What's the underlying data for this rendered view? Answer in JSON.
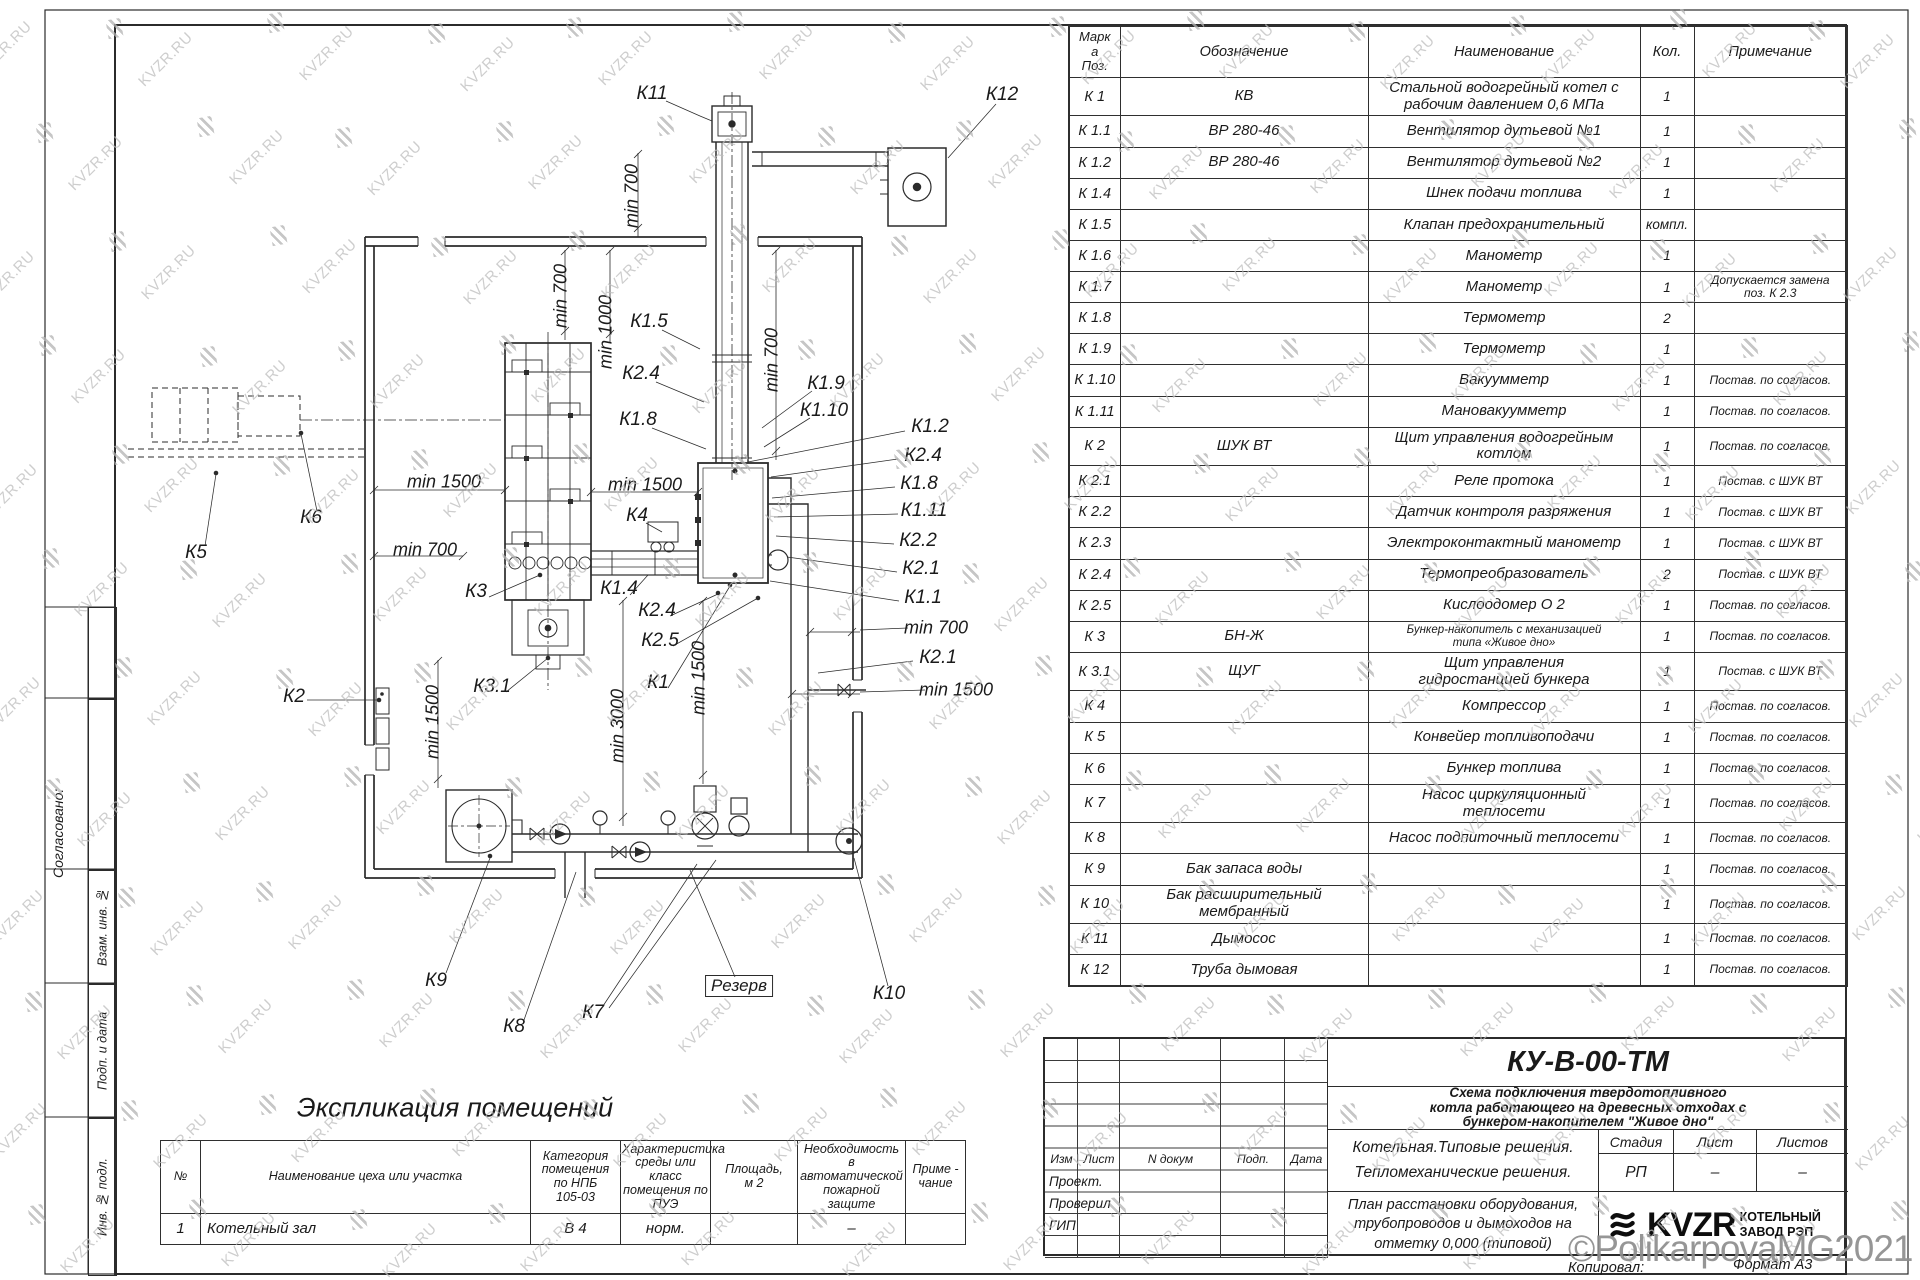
{
  "page": {
    "copyright": "©PolikarpovaMG2021",
    "format_note": "Формат А3",
    "copied_label": "Копировал:"
  },
  "watermark": {
    "text": "KVZR.RU"
  },
  "margin_stamps": {
    "approved": "Сог­ласовано:",
    "cells": [
      "Взам. инв. №",
      "Подп. и дата",
      "Инв. № подл."
    ]
  },
  "spec_table": {
    "headers": {
      "pos": "Марк\nа\nПоз.",
      "des": "Обозначение",
      "name": "Наименование",
      "qty": "Кол.",
      "note": "Примечание"
    },
    "rows": [
      {
        "pos": "К 1",
        "des": "КВ",
        "name": "Стальной водогрейный котел с\nрабочим давлением 0,6 МПа",
        "qty": "1",
        "note": ""
      },
      {
        "pos": "К 1.1",
        "des": "ВР 280-46",
        "name": "Вентилятор дутьевой №1",
        "qty": "1",
        "note": ""
      },
      {
        "pos": "К 1.2",
        "des": "ВР 280-46",
        "name": "Вентилятор дутьевой №2",
        "qty": "1",
        "note": ""
      },
      {
        "pos": "К 1.4",
        "des": "",
        "name": "Шнек подачи топлива",
        "qty": "1",
        "note": ""
      },
      {
        "pos": "К 1.5",
        "des": "",
        "name": "Клапан предохранительный",
        "qty": "компл.",
        "note": ""
      },
      {
        "pos": "К 1.6",
        "des": "",
        "name": "Манометр",
        "qty": "1",
        "note": ""
      },
      {
        "pos": "К 1.7",
        "des": "",
        "name": "Манометр",
        "qty": "1",
        "note": "Допускается замена\nпоз. К 2.3"
      },
      {
        "pos": "К 1.8",
        "des": "",
        "name": "Термометр",
        "qty": "2",
        "note": ""
      },
      {
        "pos": "К 1.9",
        "des": "",
        "name": "Термометр",
        "qty": "1",
        "note": ""
      },
      {
        "pos": "К 1.10",
        "des": "",
        "name": "Вакуумметр",
        "qty": "1",
        "note": "Постав. по согласов."
      },
      {
        "pos": "К 1.11",
        "des": "",
        "name": "Мановакуумметр",
        "qty": "1",
        "note": "Постав. по согласов."
      },
      {
        "pos": "К 2",
        "des": "ШУК ВТ",
        "name": "Щит управления водогрейным\nкотлом",
        "qty": "1",
        "note": "Постав. по согласов."
      },
      {
        "pos": "К 2.1",
        "des": "",
        "name": "Реле протока",
        "qty": "1",
        "note": "Постав. с ШУК ВТ"
      },
      {
        "pos": "К 2.2",
        "des": "",
        "name": "Датчик контроля разряжения",
        "qty": "1",
        "note": "Постав. с ШУК ВТ"
      },
      {
        "pos": "К 2.3",
        "des": "",
        "name": "Электроконтактный манометр",
        "qty": "1",
        "note": "Постав. с ШУК ВТ"
      },
      {
        "pos": "К 2.4",
        "des": "",
        "name": "Термопреобразователь",
        "qty": "2",
        "note": "Постав. с ШУК ВТ"
      },
      {
        "pos": "К 2.5",
        "des": "",
        "name": "Кислоодомер О 2",
        "qty": "1",
        "note": "Постав. по согласов."
      },
      {
        "pos": "К 3",
        "des": "БН-Ж",
        "name": "Бункер-накопитель с механизацией\nтипа «Живое дно»",
        "qty": "1",
        "note": "Постав. по согласов."
      },
      {
        "pos": "К 3.1",
        "des": "ЩУГ",
        "name": "Щит управления\nгидростанцией бункера",
        "qty": "1",
        "note": "Постав. с ШУК ВТ"
      },
      {
        "pos": "К 4",
        "des": "",
        "name": "Компрессор",
        "qty": "1",
        "note": "Постав. по согласов."
      },
      {
        "pos": "К 5",
        "des": "",
        "name": "Конвейер топливоподачи",
        "qty": "1",
        "note": "Постав. по согласов."
      },
      {
        "pos": "К 6",
        "des": "",
        "name": "Бункер топлива",
        "qty": "1",
        "note": "Постав. по согласов."
      },
      {
        "pos": "К 7",
        "des": "",
        "name": "Насос циркуляционный\nтеплосети",
        "qty": "1",
        "note": "Постав. по согласов."
      },
      {
        "pos": "К 8",
        "des": "",
        "name": "Насос подпиточный теплосети",
        "qty": "1",
        "note": "Постав. по согласов."
      },
      {
        "pos": "К 9",
        "des": "Бак запаса воды",
        "name": "",
        "qty": "1",
        "note": "Постав. по согласов."
      },
      {
        "pos": "К 10",
        "des": "Бак расширительный\nмембранный",
        "name": "",
        "qty": "1",
        "note": "Постав. по согласов."
      },
      {
        "pos": "К 11",
        "des": "Дымосос",
        "name": "",
        "qty": "1",
        "note": "Постав. по согласов."
      },
      {
        "pos": "К 12",
        "des": "Труба дымовая",
        "name": "",
        "qty": "1",
        "note": "Постав. по согласов."
      }
    ]
  },
  "explication": {
    "title": "Экспликация помещений",
    "headers": [
      "№",
      "Наименование цеха или участка",
      "Категория\nпомещения\nпо НПБ\n105-03",
      "Характеристика\nсреды или класс\nпомещения по\nПУЭ",
      "Площадь,\nм 2",
      "Необходимость в\nавтоматической\nпожарной защите",
      "Приме -\nчание"
    ],
    "rows": [
      [
        "1",
        "Котельный зал",
        "В 4",
        "норм.",
        "",
        "–",
        ""
      ]
    ]
  },
  "title_block": {
    "doc_code": "КУ-В-00-ТМ",
    "description": "Схема подключения твердотопливного\nкотла работающего на древесных отходах с\nбункером-накопителем \"Живое дно\"",
    "change_cols": [
      "Изм",
      "Лист",
      "N докум",
      "Подп.",
      "Дата"
    ],
    "roles": [
      "Проект.",
      "Проверил",
      "ГИП"
    ],
    "project": "Котельная.Типовые решения.\nТепломеханические решения.",
    "stage_headers": [
      "Стадия",
      "Лист",
      "Листов"
    ],
    "stage_values": [
      "РП",
      "–",
      "–"
    ],
    "sheet_title": "План расстановки оборудования,\nтрубопроводов и дымоходов на\nотметку 0,000 (типовой)",
    "logo_text": "KVZR",
    "company": "КОТЕЛЬНЫЙ\nЗАВОД РЭП"
  },
  "plan": {
    "labels": [
      {
        "t": "К11",
        "x": 652,
        "y": 94
      },
      {
        "t": "К12",
        "x": 1002,
        "y": 95
      },
      {
        "t": "min 700",
        "x": 632,
        "y": 196,
        "rot": 1,
        "dim": 1
      },
      {
        "t": "min 700",
        "x": 561,
        "y": 296,
        "rot": 1,
        "dim": 1
      },
      {
        "t": "min 1000",
        "x": 606,
        "y": 332,
        "rot": 1,
        "dim": 1
      },
      {
        "t": "min 700",
        "x": 772,
        "y": 360,
        "rot": 1,
        "dim": 1
      },
      {
        "t": "К1.5",
        "x": 649,
        "y": 322
      },
      {
        "t": "К2.4",
        "x": 641,
        "y": 374
      },
      {
        "t": "К1.8",
        "x": 638,
        "y": 420
      },
      {
        "t": "К1.9",
        "x": 826,
        "y": 384
      },
      {
        "t": "К1.10",
        "x": 824,
        "y": 411
      },
      {
        "t": "К1.2",
        "x": 930,
        "y": 427
      },
      {
        "t": "К2.4",
        "x": 923,
        "y": 456
      },
      {
        "t": "К1.8",
        "x": 919,
        "y": 484
      },
      {
        "t": "К1.11",
        "x": 924,
        "y": 511
      },
      {
        "t": "К2.2",
        "x": 918,
        "y": 541
      },
      {
        "t": "К2.1",
        "x": 921,
        "y": 569
      },
      {
        "t": "К1.1",
        "x": 923,
        "y": 598
      },
      {
        "t": "min 700",
        "x": 936,
        "y": 628,
        "dim": 1
      },
      {
        "t": "К2.1",
        "x": 938,
        "y": 658
      },
      {
        "t": "min 1500",
        "x": 956,
        "y": 690,
        "dim": 1
      },
      {
        "t": "min 1500",
        "x": 444,
        "y": 482,
        "dim": 1
      },
      {
        "t": "min 1500",
        "x": 645,
        "y": 485,
        "dim": 1
      },
      {
        "t": "min 700",
        "x": 425,
        "y": 550,
        "dim": 1
      },
      {
        "t": "К4",
        "x": 637,
        "y": 516
      },
      {
        "t": "К3",
        "x": 476,
        "y": 592
      },
      {
        "t": "К1.4",
        "x": 619,
        "y": 589
      },
      {
        "t": "К2.4",
        "x": 657,
        "y": 611
      },
      {
        "t": "К2.5",
        "x": 660,
        "y": 641
      },
      {
        "t": "К3.1",
        "x": 492,
        "y": 687
      },
      {
        "t": "К1",
        "x": 658,
        "y": 683
      },
      {
        "t": "К2",
        "x": 294,
        "y": 697
      },
      {
        "t": "min 1500",
        "x": 433,
        "y": 722,
        "rot": 1,
        "dim": 1
      },
      {
        "t": "min 3000",
        "x": 618,
        "y": 726,
        "rot": 1,
        "dim": 1
      },
      {
        "t": "min 1500",
        "x": 699,
        "y": 678,
        "rot": 1,
        "dim": 1
      },
      {
        "t": "К5",
        "x": 196,
        "y": 553
      },
      {
        "t": "К6",
        "x": 311,
        "y": 518
      },
      {
        "t": "К9",
        "x": 436,
        "y": 981
      },
      {
        "t": "К8",
        "x": 514,
        "y": 1027
      },
      {
        "t": "К7",
        "x": 593,
        "y": 1013
      },
      {
        "t": "Резерв",
        "x": 739,
        "y": 986,
        "box": 1
      },
      {
        "t": "К10",
        "x": 889,
        "y": 994
      }
    ]
  }
}
